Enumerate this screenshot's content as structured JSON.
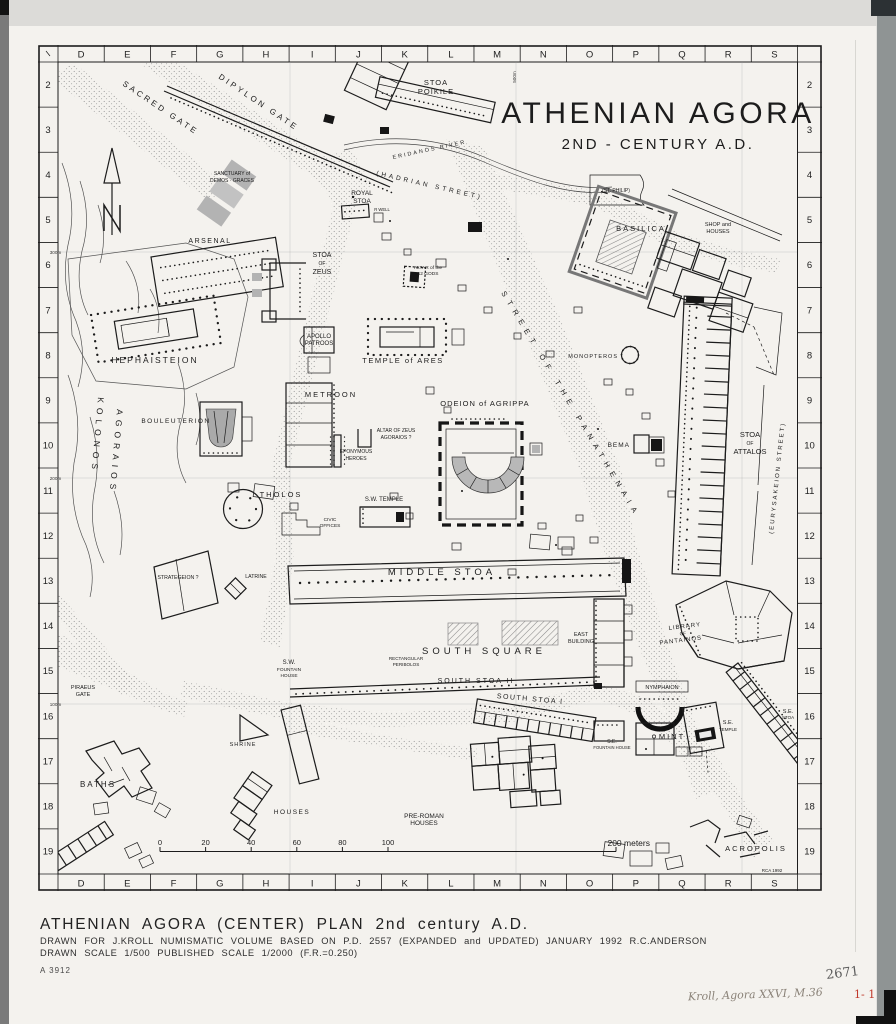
{
  "colors": {
    "paper": "#f4f2ee",
    "ink": "#1c1c1c",
    "band_gray": "#8f9494",
    "red_mark": "#c0392b"
  },
  "map": {
    "title": "ATHENIAN AGORA",
    "subtitle": "2ND - CENTURY A.D.",
    "labels": [
      {
        "t": "SACRED GATE",
        "x": 84,
        "y": 40,
        "fs": 8,
        "ls": 3,
        "r": 34,
        "a": "s"
      },
      {
        "t": "DIPYLON GATE",
        "x": 180,
        "y": 33,
        "fs": 8,
        "ls": 3,
        "r": 34,
        "a": "s"
      },
      {
        "t": "STOA",
        "x": 398,
        "y": 40,
        "fs": 7.5,
        "ls": 1
      },
      {
        "t": "POIKILE",
        "x": 398,
        "y": 49,
        "fs": 7.5,
        "ls": 1
      },
      {
        "t": "ERIDANOS RIVER",
        "x": 355,
        "y": 114,
        "fs": 5.5,
        "ls": 2,
        "r": -12,
        "a": "s"
      },
      {
        "t": "(HADRIAN STREET)",
        "x": 338,
        "y": 130,
        "fs": 6.5,
        "ls": 3,
        "r": 13,
        "a": "s"
      },
      {
        "t": "(ST. PHILIP)",
        "x": 578,
        "y": 147,
        "fs": 5
      },
      {
        "t": "SANCTUARY of",
        "x": 194,
        "y": 130,
        "fs": 5
      },
      {
        "t": "DEMOS · GRACES",
        "x": 194,
        "y": 137,
        "fs": 5
      },
      {
        "t": "ROYAL",
        "x": 324,
        "y": 150,
        "fs": 6.5
      },
      {
        "t": "STOA",
        "x": 324,
        "y": 158,
        "fs": 6.5
      },
      {
        "t": "R WELL",
        "x": 344,
        "y": 166,
        "fs": 4.2
      },
      {
        "t": "ARSENAL",
        "x": 172,
        "y": 198,
        "fs": 7,
        "ls": 1.5
      },
      {
        "t": "STOA",
        "x": 284,
        "y": 212,
        "fs": 7
      },
      {
        "t": "OF",
        "x": 284,
        "y": 220,
        "fs": 5
      },
      {
        "t": "ZEUS",
        "x": 284,
        "y": 229,
        "fs": 7
      },
      {
        "t": "ALTAR of the",
        "x": 390,
        "y": 224,
        "fs": 4.8
      },
      {
        "t": "12 GODS",
        "x": 390,
        "y": 230,
        "fs": 4.8
      },
      {
        "t": "BASILICA",
        "x": 603,
        "y": 186,
        "fs": 7.5,
        "ls": 2
      },
      {
        "t": "SHOP and",
        "x": 680,
        "y": 181,
        "fs": 5.5
      },
      {
        "t": "HOUSES",
        "x": 680,
        "y": 188,
        "fs": 5.5
      },
      {
        "t": "HEPHAISTEION",
        "x": 117,
        "y": 318,
        "fs": 8.5,
        "ls": 2
      },
      {
        "t": "APOLLO",
        "x": 281,
        "y": 293,
        "fs": 6
      },
      {
        "t": "PATROOS",
        "x": 281,
        "y": 300,
        "fs": 6
      },
      {
        "t": "TEMPLE of ARES",
        "x": 365,
        "y": 318,
        "fs": 7.5,
        "ls": 1.5
      },
      {
        "t": "MONOPTEROS",
        "x": 580,
        "y": 313,
        "fs": 5.5,
        "ls": 1,
        "a": "e"
      },
      {
        "t": "METROON",
        "x": 293,
        "y": 352,
        "fs": 7.5,
        "ls": 2
      },
      {
        "t": "BOULEUTERION",
        "x": 138,
        "y": 378,
        "fs": 6.5,
        "ls": 1.5
      },
      {
        "t": "KOLONOS",
        "x": 60,
        "y": 352,
        "fs": 8.5,
        "ls": 5,
        "r": 95,
        "a": "s"
      },
      {
        "t": "AGORAIOS",
        "x": 79,
        "y": 364,
        "fs": 8.5,
        "ls": 5,
        "r": 95,
        "a": "s"
      },
      {
        "t": "ODEION of AGRIPPA",
        "x": 447,
        "y": 361,
        "fs": 7.5,
        "ls": 1
      },
      {
        "t": "ALTAR OF ZEUS",
        "x": 358,
        "y": 387,
        "fs": 5
      },
      {
        "t": "AGORAIOS ?",
        "x": 358,
        "y": 394,
        "fs": 5
      },
      {
        "t": "EPONYMOUS",
        "x": 318,
        "y": 408,
        "fs": 5
      },
      {
        "t": "HEROES",
        "x": 318,
        "y": 415,
        "fs": 5
      },
      {
        "t": "BEMA",
        "x": 592,
        "y": 402,
        "fs": 6.5,
        "ls": 1,
        "a": "e"
      },
      {
        "t": "STOA",
        "x": 712,
        "y": 392,
        "fs": 7.5
      },
      {
        "t": "OF",
        "x": 712,
        "y": 400,
        "fs": 5
      },
      {
        "t": "ATTALOS",
        "x": 712,
        "y": 409,
        "fs": 7.5
      },
      {
        "t": "(EURYSAKEION  STREET)",
        "x": 735,
        "y": 489,
        "fs": 6,
        "ls": 2,
        "r": -84,
        "a": "s"
      },
      {
        "t": "STREET  OF  THE  PANATHENAIA",
        "x": 463,
        "y": 248,
        "fs": 7.5,
        "ls": 6,
        "r": 59,
        "a": "s"
      },
      {
        "t": "THOLOS",
        "x": 243,
        "y": 452,
        "fs": 7.5,
        "ls": 2
      },
      {
        "t": "S.W. TEMPLE",
        "x": 346,
        "y": 456,
        "fs": 6
      },
      {
        "t": "CIVIC",
        "x": 292,
        "y": 476,
        "fs": 4.8
      },
      {
        "t": "OFFICES",
        "x": 292,
        "y": 482,
        "fs": 4.8
      },
      {
        "t": "STRATEGEION ?",
        "x": 140,
        "y": 534,
        "fs": 5.2
      },
      {
        "t": "LATRINE",
        "x": 218,
        "y": 533,
        "fs": 5.2
      },
      {
        "t": "MIDDLE  STOA",
        "x": 404,
        "y": 530,
        "fs": 9.5,
        "ls": 4
      },
      {
        "t": "S.W.",
        "x": 251,
        "y": 619,
        "fs": 6
      },
      {
        "t": "FOUNTAIN",
        "x": 251,
        "y": 626,
        "fs": 4.8
      },
      {
        "t": "HOUSE",
        "x": 251,
        "y": 632,
        "fs": 4.8
      },
      {
        "t": "RECTANGULAR",
        "x": 368,
        "y": 615,
        "fs": 4.6
      },
      {
        "t": "PERIBOLOS",
        "x": 368,
        "y": 621,
        "fs": 4.6
      },
      {
        "t": "SOUTH  SQUARE",
        "x": 446,
        "y": 609,
        "fs": 9.5,
        "ls": 4
      },
      {
        "t": "EAST",
        "x": 543,
        "y": 591,
        "fs": 5.5
      },
      {
        "t": "BUILDING",
        "x": 543,
        "y": 598,
        "fs": 5.5
      },
      {
        "t": "SOUTH STOA II",
        "x": 438,
        "y": 638,
        "fs": 7,
        "ls": 2
      },
      {
        "t": "SOUTH STOA I",
        "x": 492,
        "y": 656,
        "fs": 7,
        "ls": 1.5,
        "r": 5
      },
      {
        "t": "NYMPHAION",
        "x": 624,
        "y": 644,
        "fs": 5.5
      },
      {
        "t": "LIBRARY",
        "x": 647,
        "y": 583,
        "fs": 6,
        "ls": 1,
        "r": -7
      },
      {
        "t": "OF",
        "x": 645,
        "y": 590,
        "fs": 4.5,
        "r": -7
      },
      {
        "t": "PANTAINOS",
        "x": 643,
        "y": 597,
        "fs": 6,
        "ls": 1,
        "r": -7
      },
      {
        "t": "PIRAEUS",
        "x": 45,
        "y": 644,
        "fs": 5.5
      },
      {
        "t": "GATE",
        "x": 45,
        "y": 651,
        "fs": 5.5
      },
      {
        "t": "SHRINE",
        "x": 205,
        "y": 701,
        "fs": 5.5,
        "ls": 1
      },
      {
        "t": "MINT",
        "x": 634,
        "y": 694,
        "fs": 7.5,
        "ls": 2
      },
      {
        "t": "S.E.",
        "x": 690,
        "y": 679,
        "fs": 5.5
      },
      {
        "t": "TEMPLE",
        "x": 690,
        "y": 686,
        "fs": 4.5
      },
      {
        "t": "S.E.",
        "x": 750,
        "y": 668,
        "fs": 5.5
      },
      {
        "t": "STOA",
        "x": 750,
        "y": 674,
        "fs": 4.5
      },
      {
        "t": "S.E.",
        "x": 574,
        "y": 698,
        "fs": 5
      },
      {
        "t": "FOUNTAIN HOUSE",
        "x": 574,
        "y": 704,
        "fs": 4.2
      },
      {
        "t": "BATHS",
        "x": 60,
        "y": 742,
        "fs": 8,
        "ls": 2
      },
      {
        "t": "HOUSES",
        "x": 254,
        "y": 769,
        "fs": 6.5,
        "ls": 1.5
      },
      {
        "t": "PRE-ROMAN",
        "x": 386,
        "y": 773,
        "fs": 6.5
      },
      {
        "t": "HOUSES",
        "x": 386,
        "y": 780,
        "fs": 6.5
      },
      {
        "t": "ACROPOLIS",
        "x": 718,
        "y": 806,
        "fs": 7.5,
        "ls": 2
      },
      {
        "t": "RCA 1992",
        "x": 734,
        "y": 827,
        "fs": 4.5
      },
      {
        "t": "200 meters",
        "x": 612,
        "y": 801,
        "fs": 8.5,
        "a": "e"
      }
    ]
  },
  "grid": {
    "columns": [
      "D",
      "E",
      "F",
      "G",
      "H",
      "I",
      "J",
      "K",
      "L",
      "M",
      "N",
      "O",
      "P",
      "Q",
      "R",
      "S"
    ],
    "rows": [
      "2",
      "3",
      "4",
      "5",
      "6",
      "7",
      "8",
      "9",
      "10",
      "11",
      "12",
      "13",
      "14",
      "15",
      "16",
      "17",
      "18",
      "19"
    ],
    "left_ticks": [
      {
        "t": "300m",
        "y": 207
      },
      {
        "t": "200m",
        "y": 433
      },
      {
        "t": "100m",
        "y": 659
      }
    ],
    "top_ticks": [
      {
        "t": "500m",
        "x": 478
      }
    ]
  },
  "scale_bar": {
    "tick_labels": [
      "0",
      "20",
      "40",
      "60",
      "80",
      "100"
    ]
  },
  "caption": {
    "title": "ATHENIAN AGORA (CENTER) PLAN 2nd century A.D.",
    "line2": "DRAWN FOR J.KROLL NUMISMATIC VOLUME BASED ON P.D. 2557 (EXPANDED and UPDATED) JANUARY 1992 R.C.ANDERSON",
    "line3": "DRAWN SCALE 1/500 PUBLISHED SCALE 1/2000 (F.R.=0.250)",
    "negative_number": "A 3912"
  },
  "annotations": {
    "plate_number": "2671",
    "citation": "Kroll, Agora XXVI, M.36",
    "red_mark": "1- 1"
  }
}
